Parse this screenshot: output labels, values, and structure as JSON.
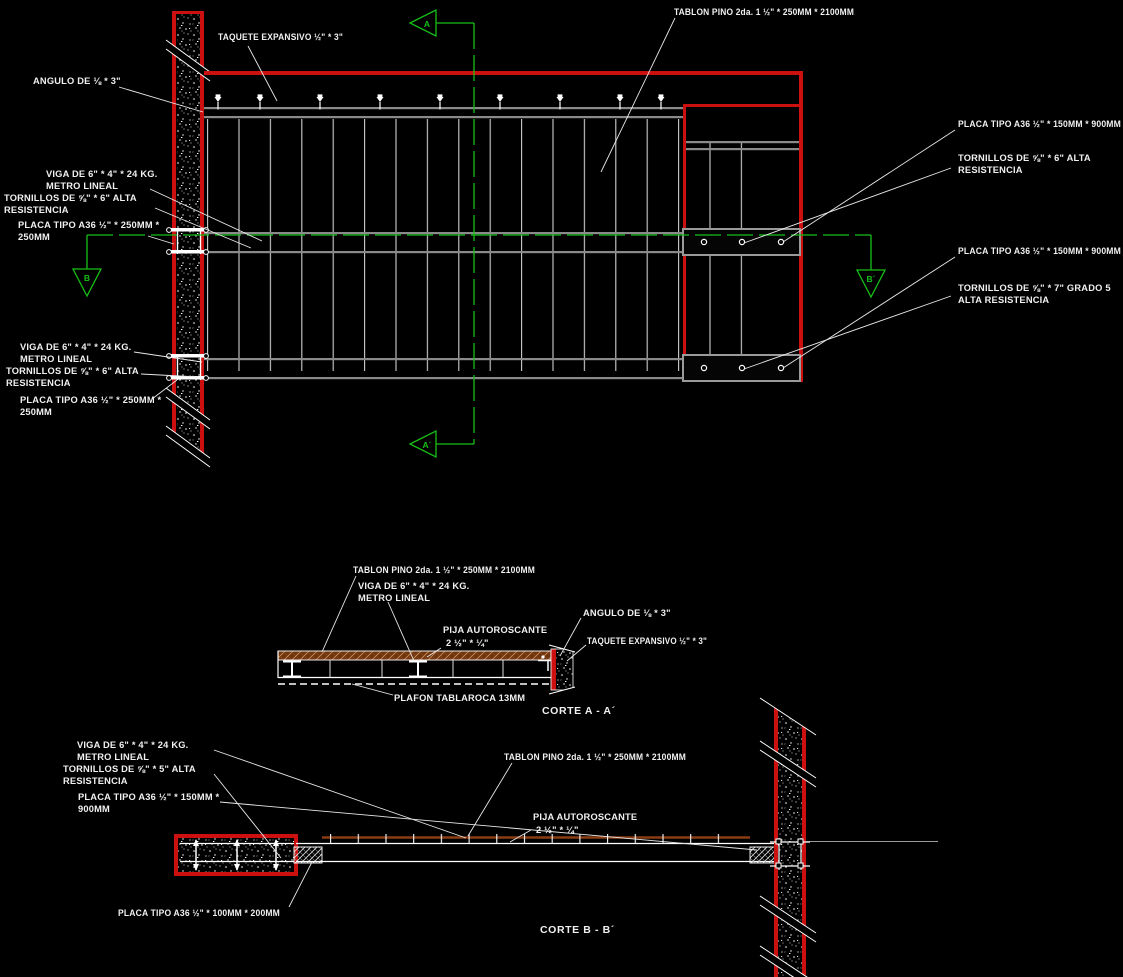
{
  "colors": {
    "background": "#000000",
    "wall_red": "#cc1010",
    "section_green": "#16c016",
    "beam_gray": "#8a8a8a",
    "line_white": "#e8e8e8",
    "wood_brown": "#6f3510"
  },
  "labels": {
    "taquete": "TAQUETE EXPANSIVO ½\" * 3\"",
    "angulo": "ANGULO DE ⅛ * 3\"",
    "tablon": "TABLON PINO 2da. 1 ½\" * 250MM * 2100MM",
    "viga_1": "VIGA DE 6\" * 4\" * 24 KG.",
    "viga_2": "METRO LINEAL",
    "tornillos6_1": "TORNILLOS DE ⅝\" * 6\" ALTA",
    "tornillos6_2": "RESISTENCIA",
    "tornillos5_1": "TORNILLOS DE ⅝\" * 5\" ALTA",
    "tornillos5_2": "RESISTENCIA",
    "tornillos7_1": "TORNILLOS DE ⅝\" * 7\" GRADO 5",
    "tornillos7_2": "ALTA RESISTENCIA",
    "placa_250_1": "PLACA TIPO A36 ½\" * 250MM *",
    "placa_250_2": "250MM",
    "placa_150_900": "PLACA TIPO A36 ½\" * 150MM * 900MM",
    "placa_150_1": "PLACA TIPO A36 ½\" * 150MM *",
    "placa_150_2": "900MM",
    "placa_100_200": "PLACA TIPO A36 ½\" * 100MM * 200MM",
    "pija_1": "PIJA AUTOROSCANTE",
    "pija_2": "2 ½\" * ¼\"",
    "plafon": "PLAFON TABLAROCA 13MM"
  },
  "markers": {
    "a_top": "A",
    "a_bottom": "A´",
    "b_left": "B",
    "b_right": "B´"
  },
  "titles": {
    "corte_a": "CORTE A - A´",
    "corte_b": "CORTE B - B´"
  }
}
